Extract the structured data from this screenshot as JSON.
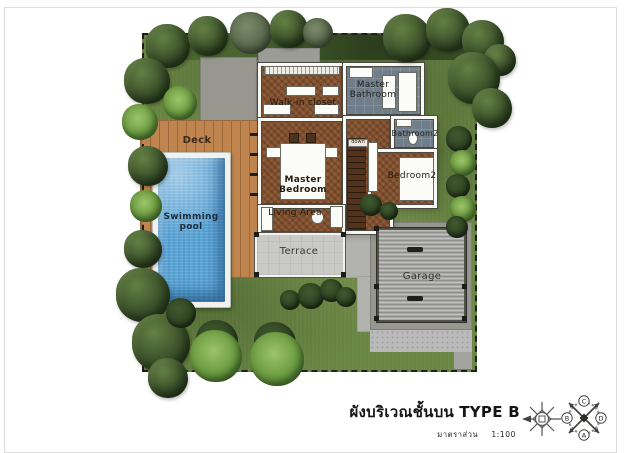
{
  "title_block": {
    "title_thai": "ผังบริเวณชั้นบน",
    "type_label": "TYPE B",
    "scale_caption": "มาตราส่วน",
    "scale_value": "1:100"
  },
  "rooms": {
    "deck": "Deck",
    "swimming_pool": "Swimming\npool",
    "walk_in_closet": "Walk-in closet",
    "master_bathroom": "Master\nBathroom",
    "bathroom2": "Bathroom2",
    "bedroom2": "Bedroom2",
    "master_bedroom": "Master\nBedroom",
    "living_area": "Living Area",
    "terrace": "Terrace",
    "garage": "Garage",
    "stairs_note": "down"
  },
  "compass": {
    "points": [
      "C",
      "D",
      "A",
      "B"
    ]
  },
  "colors": {
    "grass": "#6d8947",
    "hedge": "#3e5829",
    "deck_wood": "#c0854f",
    "pool_water": "#5aa4d6",
    "floor_wood": "#83502e",
    "bath_slate": "#6f7e8a",
    "terrace": "#c9c9c5",
    "garage_roof": "#a6a6a3",
    "concrete_pad": "#97978f"
  }
}
